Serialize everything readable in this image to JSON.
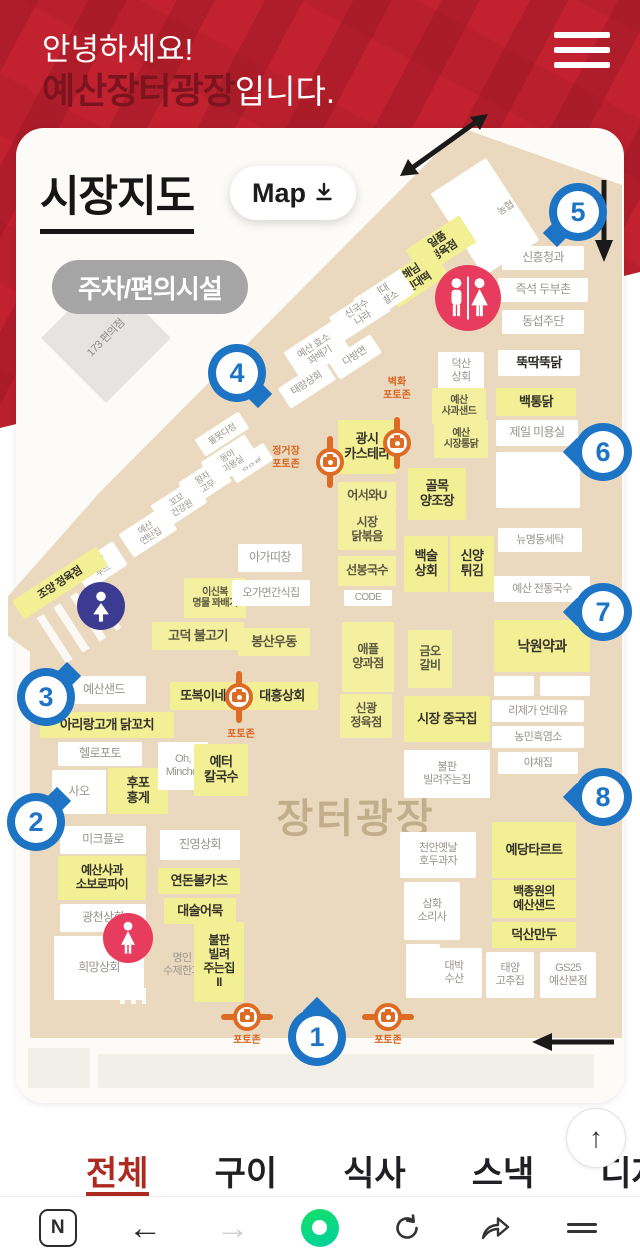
{
  "header": {
    "greeting": "안녕하세요!",
    "site_name": "예산장터광장",
    "site_suffix": "입니다.",
    "brand_color": "#c2212f",
    "brand_dark_color": "#7c1420"
  },
  "map_section": {
    "title": "시장지도",
    "map_button_label": "Map",
    "badge_label": "주차/편의시설",
    "plaza_label": "장터광장",
    "marker_color": "#1d74c4",
    "photozone_color": "#dd6b24",
    "stall_highlight_color": "#f3ef94",
    "road_color": "#ebd9bf",
    "markers": [
      {
        "n": "1",
        "x": 317,
        "y": 1037,
        "tail": "up"
      },
      {
        "n": "2",
        "x": 36,
        "y": 822,
        "tail": "tr"
      },
      {
        "n": "3",
        "x": 46,
        "y": 697,
        "tail": "tr"
      },
      {
        "n": "4",
        "x": 237,
        "y": 373,
        "tail": "br"
      },
      {
        "n": "5",
        "x": 578,
        "y": 212,
        "tail": "bl"
      },
      {
        "n": "6",
        "x": 603,
        "y": 452,
        "tail": "left"
      },
      {
        "n": "7",
        "x": 603,
        "y": 612,
        "tail": "left"
      },
      {
        "n": "8",
        "x": 603,
        "y": 797,
        "tail": "left"
      }
    ],
    "photozones": [
      {
        "x": 397,
        "y": 443,
        "line": "v",
        "label": "벽화\n포토존",
        "dx": 0,
        "dy": -66
      },
      {
        "x": 330,
        "y": 462,
        "line": "v",
        "label": "정거장\n포토존",
        "dx": -44,
        "dy": -16
      },
      {
        "x": 239,
        "y": 697,
        "line": "v",
        "label": "포토존",
        "dx": 2,
        "dy": 32
      },
      {
        "x": 247,
        "y": 1017,
        "line": "h",
        "label": "포토존",
        "dx": 0,
        "dy": 18
      },
      {
        "x": 388,
        "y": 1017,
        "line": "h",
        "label": "포토존",
        "dx": 0,
        "dy": 18
      }
    ],
    "facilities": [
      {
        "kind": "restroom",
        "x": 468,
        "y": 298,
        "d": 66
      },
      {
        "kind": "male",
        "x": 101,
        "y": 606,
        "d": 48
      },
      {
        "kind": "female",
        "x": 128,
        "y": 938,
        "d": 50
      }
    ],
    "stalls": [
      {
        "n": "",
        "t": "w",
        "x": 452,
        "y": 168,
        "w": 66,
        "h": 98,
        "r": -33
      },
      {
        "n": "농협",
        "t": "g",
        "x": 484,
        "y": 196,
        "w": 44,
        "h": 26,
        "r": -33,
        "f": 10
      },
      {
        "n": "일품\n정육점",
        "t": "yb",
        "x": 409,
        "y": 230,
        "w": 64,
        "h": 32,
        "r": -33,
        "f": 11
      },
      {
        "n": "해님\n빈대떡",
        "t": "yb",
        "x": 385,
        "y": 262,
        "w": 60,
        "h": 32,
        "r": -33,
        "f": 11
      },
      {
        "n": "현대\n이발소",
        "t": "w",
        "x": 356,
        "y": 282,
        "w": 56,
        "h": 28,
        "r": -33,
        "f": 10
      },
      {
        "n": "신국수\n나라",
        "t": "w",
        "x": 332,
        "y": 300,
        "w": 56,
        "h": 28,
        "r": -33,
        "f": 10
      },
      {
        "n": "예산 효소\n꽈배기",
        "t": "w",
        "x": 288,
        "y": 334,
        "w": 58,
        "h": 34,
        "r": -33,
        "f": 10
      },
      {
        "n": "태랑상회",
        "t": "w",
        "x": 280,
        "y": 372,
        "w": 54,
        "h": 24,
        "r": -33,
        "f": 10
      },
      {
        "n": "다방면",
        "t": "w",
        "x": 330,
        "y": 346,
        "w": 50,
        "h": 22,
        "r": -33,
        "f": 10
      },
      {
        "n": "둘못다정",
        "t": "w",
        "x": 196,
        "y": 424,
        "w": 52,
        "h": 20,
        "r": -33,
        "f": 9
      },
      {
        "n": "생랑올",
        "t": "w",
        "x": 228,
        "y": 453,
        "w": 44,
        "h": 20,
        "r": -33,
        "f": 9
      },
      {
        "n": "동아\n미용실",
        "t": "w",
        "x": 204,
        "y": 446,
        "w": 52,
        "h": 28,
        "r": -33,
        "f": 9
      },
      {
        "n": "왕자\n고무",
        "t": "w",
        "x": 182,
        "y": 468,
        "w": 46,
        "h": 28,
        "r": -33,
        "f": 9
      },
      {
        "n": "꼬꼬\n건강원",
        "t": "w",
        "x": 154,
        "y": 490,
        "w": 50,
        "h": 28,
        "r": -33,
        "f": 9
      },
      {
        "n": "예산\n연탄집",
        "t": "w",
        "x": 122,
        "y": 518,
        "w": 52,
        "h": 28,
        "r": -33,
        "f": 9
      },
      {
        "n": "조양\n푸드",
        "t": "w",
        "x": 76,
        "y": 552,
        "w": 48,
        "h": 28,
        "r": -33,
        "f": 9
      },
      {
        "n": "조양 정육점",
        "t": "yb",
        "x": 10,
        "y": 572,
        "w": 100,
        "h": 22,
        "r": -33,
        "f": 11
      },
      {
        "n": "173 편의점",
        "t": "cv",
        "x": 60,
        "y": 292,
        "w": 92,
        "h": 92,
        "r": -45,
        "f": 11
      },
      {
        "n": "신흥청과",
        "t": "w",
        "x": 502,
        "y": 246,
        "w": 82,
        "h": 24
      },
      {
        "n": "즉석 두부촌",
        "t": "w",
        "x": 498,
        "y": 278,
        "w": 90,
        "h": 24
      },
      {
        "n": "동섭주단",
        "t": "w",
        "x": 502,
        "y": 310,
        "w": 82,
        "h": 24
      },
      {
        "n": "뚝딱뚝닭",
        "t": "wb",
        "x": 498,
        "y": 350,
        "w": 82,
        "h": 26,
        "f": 13
      },
      {
        "n": "백통닭",
        "t": "yb",
        "x": 496,
        "y": 388,
        "w": 80,
        "h": 28,
        "f": 13
      },
      {
        "n": "제일 미용실",
        "t": "w",
        "x": 496,
        "y": 420,
        "w": 82,
        "h": 26
      },
      {
        "n": "",
        "t": "w",
        "x": 496,
        "y": 452,
        "w": 84,
        "h": 56
      },
      {
        "n": "덕산\n상회",
        "t": "w",
        "x": 438,
        "y": 352,
        "w": 46,
        "h": 38,
        "f": 11
      },
      {
        "n": "예산\n사과샌드",
        "t": "y",
        "x": 432,
        "y": 388,
        "w": 54,
        "h": 36,
        "f": 10
      },
      {
        "n": "예산\n시장통닭",
        "t": "y",
        "x": 434,
        "y": 420,
        "w": 54,
        "h": 38,
        "f": 10
      },
      {
        "n": "골목\n양조장",
        "t": "yb",
        "x": 408,
        "y": 468,
        "w": 58,
        "h": 52,
        "f": 13
      },
      {
        "n": "백술\n상회",
        "t": "yb",
        "x": 404,
        "y": 536,
        "w": 44,
        "h": 56,
        "f": 13
      },
      {
        "n": "신양\n튀김",
        "t": "yb",
        "x": 450,
        "y": 536,
        "w": 44,
        "h": 56,
        "f": 13
      },
      {
        "n": "광시\n카스테라",
        "t": "yb",
        "x": 338,
        "y": 420,
        "w": 58,
        "h": 54,
        "f": 13
      },
      {
        "n": "어서와U",
        "t": "y",
        "x": 338,
        "y": 482,
        "w": 58,
        "h": 28,
        "f": 12
      },
      {
        "n": "시장\n닭볶음",
        "t": "y",
        "x": 338,
        "y": 510,
        "w": 58,
        "h": 40,
        "f": 12
      },
      {
        "n": "선봉국수",
        "t": "y",
        "x": 338,
        "y": 556,
        "w": 58,
        "h": 30,
        "f": 12
      },
      {
        "n": "CODE",
        "t": "w",
        "x": 344,
        "y": 590,
        "w": 48,
        "h": 16,
        "f": 10
      },
      {
        "n": "애플\n양과점",
        "t": "y",
        "x": 342,
        "y": 622,
        "w": 52,
        "h": 70,
        "f": 12
      },
      {
        "n": "신광\n정육점",
        "t": "y",
        "x": 340,
        "y": 694,
        "w": 52,
        "h": 44,
        "f": 12
      },
      {
        "n": "금오\n갈비",
        "t": "y",
        "x": 408,
        "y": 630,
        "w": 44,
        "h": 58,
        "f": 12
      },
      {
        "n": "시장 중국집",
        "t": "yb",
        "x": 404,
        "y": 696,
        "w": 86,
        "h": 46,
        "f": 13
      },
      {
        "n": "불판\n빌려주는집",
        "t": "w",
        "x": 404,
        "y": 750,
        "w": 86,
        "h": 48,
        "f": 11
      },
      {
        "n": "뉴명동세탁",
        "t": "w",
        "x": 498,
        "y": 528,
        "w": 84,
        "h": 24,
        "f": 11
      },
      {
        "n": "예산 전통국수",
        "t": "w",
        "x": 494,
        "y": 576,
        "w": 96,
        "h": 26,
        "f": 11
      },
      {
        "n": "낙원약과",
        "t": "yb",
        "x": 494,
        "y": 620,
        "w": 96,
        "h": 52,
        "f": 14
      },
      {
        "n": "",
        "t": "w",
        "x": 494,
        "y": 676,
        "w": 40,
        "h": 20
      },
      {
        "n": "",
        "t": "w",
        "x": 540,
        "y": 676,
        "w": 50,
        "h": 20
      },
      {
        "n": "리제가 언데유",
        "t": "w",
        "x": 492,
        "y": 700,
        "w": 92,
        "h": 22,
        "f": 11
      },
      {
        "n": "농민흑염소",
        "t": "w",
        "x": 492,
        "y": 726,
        "w": 92,
        "h": 22,
        "f": 11
      },
      {
        "n": "야채집",
        "t": "w",
        "x": 498,
        "y": 752,
        "w": 80,
        "h": 22,
        "f": 11
      },
      {
        "n": "예당타르트",
        "t": "yb",
        "x": 492,
        "y": 822,
        "w": 84,
        "h": 56,
        "f": 13
      },
      {
        "n": "백종원의\n예산샌드",
        "t": "yb",
        "x": 492,
        "y": 880,
        "w": 84,
        "h": 38,
        "f": 12
      },
      {
        "n": "덕산만두",
        "t": "yb",
        "x": 492,
        "y": 922,
        "w": 84,
        "h": 26,
        "f": 13
      },
      {
        "n": "태양\n고추집",
        "t": "w",
        "x": 486,
        "y": 952,
        "w": 48,
        "h": 46,
        "f": 11
      },
      {
        "n": "GS25\n예산본점",
        "t": "w",
        "x": 540,
        "y": 952,
        "w": 56,
        "h": 46,
        "f": 11
      },
      {
        "n": "예산샌드",
        "t": "w",
        "x": 62,
        "y": 676,
        "w": 84,
        "h": 28
      },
      {
        "n": "아리랑고개 닭꼬치",
        "t": "yb",
        "x": 40,
        "y": 712,
        "w": 134,
        "h": 26,
        "f": 13
      },
      {
        "n": "헬로포토",
        "t": "w",
        "x": 58,
        "y": 742,
        "w": 84,
        "h": 24
      },
      {
        "n": "사오",
        "t": "w",
        "x": 52,
        "y": 770,
        "w": 54,
        "h": 44
      },
      {
        "n": "후포\n홍게",
        "t": "yb",
        "x": 108,
        "y": 768,
        "w": 60,
        "h": 46,
        "f": 13
      },
      {
        "n": "미크플로",
        "t": "w",
        "x": 60,
        "y": 826,
        "w": 86,
        "h": 28
      },
      {
        "n": "예산사과\n소보로파이",
        "t": "yb",
        "x": 58,
        "y": 856,
        "w": 88,
        "h": 44,
        "f": 12
      },
      {
        "n": "광천상회",
        "t": "w",
        "x": 60,
        "y": 904,
        "w": 86,
        "h": 28
      },
      {
        "n": "희망상회",
        "t": "w",
        "x": 54,
        "y": 936,
        "w": 90,
        "h": 64
      },
      {
        "n": "이신복\n명물 꽈배기",
        "t": "y",
        "x": 184,
        "y": 578,
        "w": 62,
        "h": 40,
        "f": 10
      },
      {
        "n": "고덕 불고기",
        "t": "y",
        "x": 152,
        "y": 622,
        "w": 92,
        "h": 28,
        "f": 13
      },
      {
        "n": "또복이네",
        "t": "yb",
        "x": 170,
        "y": 682,
        "w": 66,
        "h": 28,
        "f": 13
      },
      {
        "n": "Oh,\nMincho!",
        "t": "w",
        "x": 158,
        "y": 742,
        "w": 50,
        "h": 48,
        "f": 11
      },
      {
        "n": "예터\n칼국수",
        "t": "yb",
        "x": 194,
        "y": 744,
        "w": 54,
        "h": 52,
        "f": 13
      },
      {
        "n": "진영상회",
        "t": "w",
        "x": 160,
        "y": 830,
        "w": 80,
        "h": 30
      },
      {
        "n": "연돈볼카츠",
        "t": "yb",
        "x": 158,
        "y": 868,
        "w": 82,
        "h": 26,
        "f": 13
      },
      {
        "n": "대술어묵",
        "t": "yb",
        "x": 164,
        "y": 898,
        "w": 72,
        "h": 26,
        "f": 13
      },
      {
        "n": "명인\n수제한과",
        "t": "g",
        "x": 150,
        "y": 946,
        "w": 64,
        "h": 38,
        "f": 11
      },
      {
        "n": "불판\n빌려\n주는집\nII",
        "t": "yb",
        "x": 194,
        "y": 922,
        "w": 50,
        "h": 80,
        "f": 12
      },
      {
        "n": "아가띠창",
        "t": "w",
        "x": 238,
        "y": 544,
        "w": 64,
        "h": 28
      },
      {
        "n": "오가면간식집",
        "t": "w",
        "x": 232,
        "y": 580,
        "w": 78,
        "h": 26,
        "f": 11
      },
      {
        "n": "봉산우동",
        "t": "y",
        "x": 238,
        "y": 628,
        "w": 72,
        "h": 28,
        "f": 13
      },
      {
        "n": "대흥상회",
        "t": "yb",
        "x": 246,
        "y": 682,
        "w": 72,
        "h": 28,
        "f": 13
      },
      {
        "n": "천안옛날\n호두과자",
        "t": "w",
        "x": 400,
        "y": 832,
        "w": 76,
        "h": 46,
        "f": 11
      },
      {
        "n": "삼화\n소리사",
        "t": "w",
        "x": 404,
        "y": 882,
        "w": 56,
        "h": 58,
        "f": 11
      },
      {
        "n": "",
        "t": "w",
        "x": 406,
        "y": 944,
        "w": 34,
        "h": 54
      },
      {
        "n": "대박\n수산",
        "t": "w",
        "x": 426,
        "y": 948,
        "w": 56,
        "h": 50,
        "f": 11
      },
      {
        "n": "",
        "t": "fb",
        "x": 28,
        "y": 1048,
        "w": 62,
        "h": 40
      },
      {
        "n": "",
        "t": "fb",
        "x": 98,
        "y": 1054,
        "w": 496,
        "h": 34
      }
    ]
  },
  "category_tabs": [
    {
      "label": "전체",
      "active": true
    },
    {
      "label": "구이",
      "active": false
    },
    {
      "label": "식사",
      "active": false
    },
    {
      "label": "스낵",
      "active": false
    },
    {
      "label": "디저트",
      "active": false
    }
  ],
  "scroll_top": {
    "glyph": "↑"
  },
  "browser_toolbar": {
    "naver_label": "N",
    "back_glyph": "←",
    "forward_glyph": "→"
  }
}
